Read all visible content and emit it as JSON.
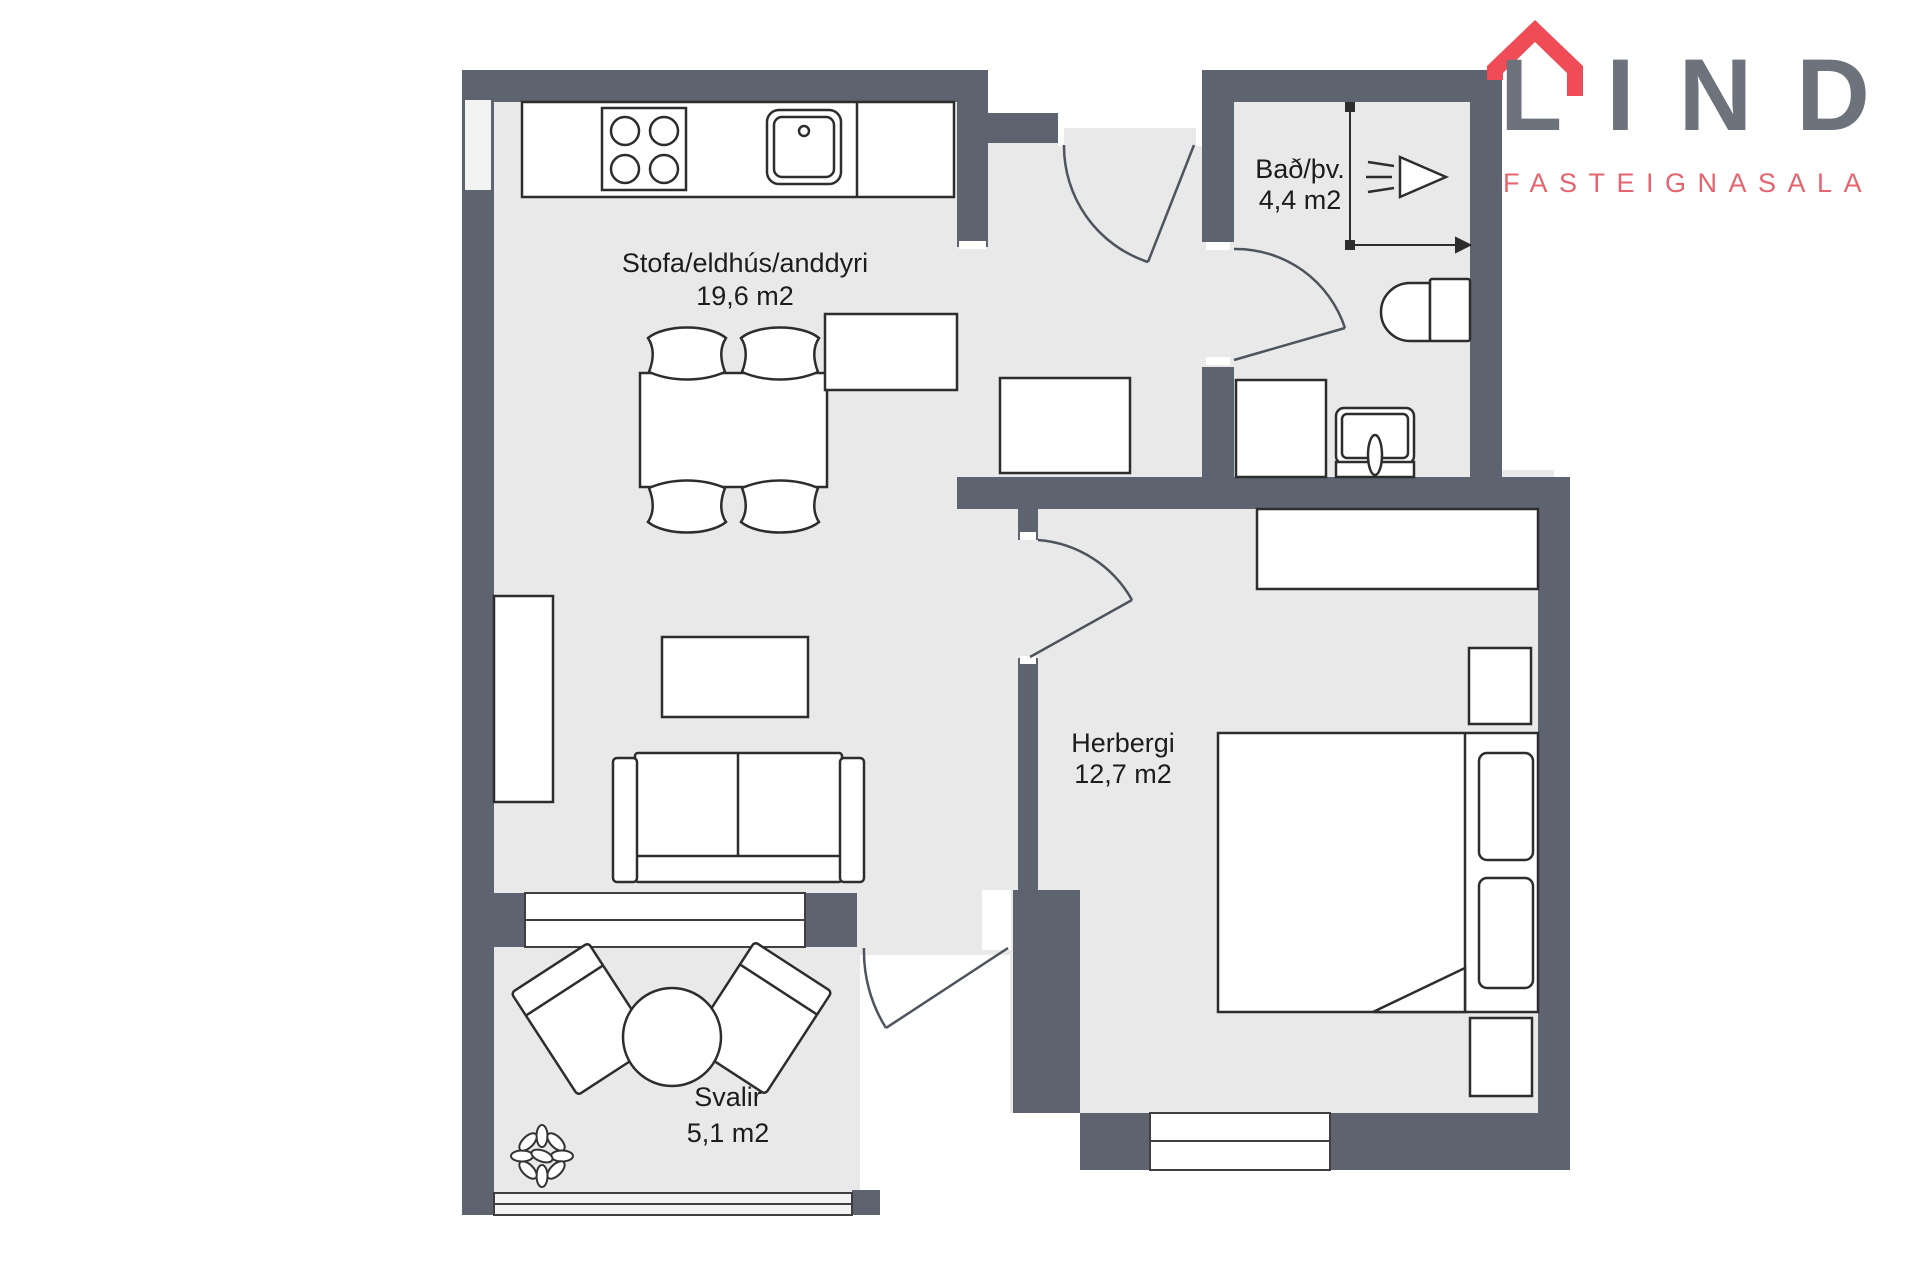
{
  "brand": {
    "name": "LIND",
    "subtitle": "FASTEIGNASALA",
    "roof_color": "#ef4c57",
    "name_color": "#6d737c",
    "subtitle_color": "#e4646f"
  },
  "rooms": [
    {
      "name": "Stofa/eldhús/anddyri",
      "area": "19,6 m2"
    },
    {
      "name": "Bað/þv.",
      "area": "4,4 m2"
    },
    {
      "name": "Herbergi",
      "area": "12,7 m2"
    },
    {
      "name": "Svalir",
      "area": "5,1 m2"
    }
  ],
  "colors": {
    "wall": "#5d6470",
    "floor": "#e9e9ea",
    "window": "#f3f3f4",
    "furniture_outline": "#2d2d2d",
    "door_line": "#4d545e",
    "background": "#ffffff"
  },
  "fixtures": [
    "stove",
    "kitchen-sink",
    "window",
    "entry-door",
    "interior-door",
    "dining-table",
    "dining-chair",
    "tv-bench",
    "coffee-table",
    "sofa",
    "cabinet",
    "sideboard",
    "washing-machine",
    "washbasin",
    "toilet",
    "shower-head",
    "bed",
    "pillow",
    "nightstand",
    "desk",
    "balcony-table",
    "balcony-chair",
    "plant",
    "balcony-railing"
  ]
}
